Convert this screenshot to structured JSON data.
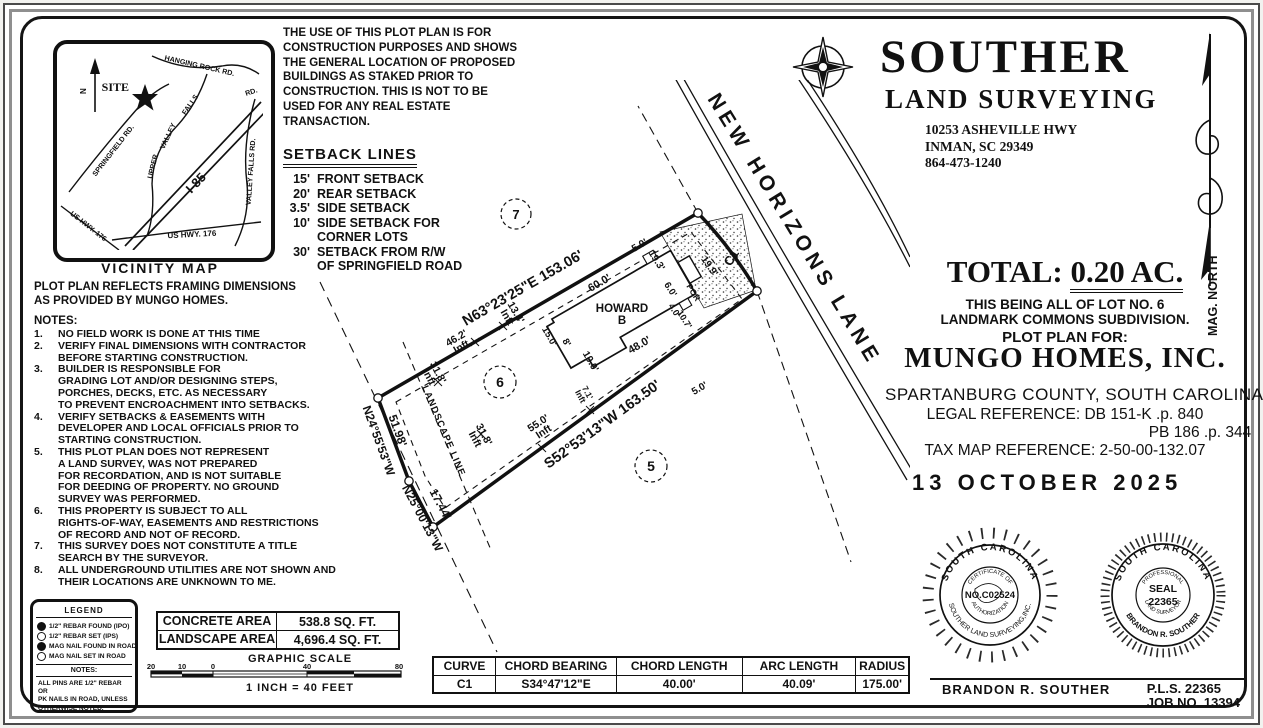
{
  "vicinity": {
    "title": "VICINITY MAP",
    "site_label": "SITE",
    "north_label": "N",
    "roads": {
      "hanging_rock": "HANGING ROCK RD.",
      "rd2": "RD.",
      "falls": "FALLS",
      "valley": "VALLEY",
      "upper": "UPPER",
      "springfield": "SPRINGFIELD RD.",
      "i85": "I-85",
      "valley_falls": "VALLEY FALLS RD.",
      "us176_a": "US HWY. 176",
      "us176_b": "US  HWY.  176"
    }
  },
  "disclaimer": {
    "lines": [
      "THE USE OF THIS PLOT PLAN IS FOR",
      "CONSTRUCTION PURPOSES AND SHOWS",
      "THE GENERAL LOCATION OF PROPOSED",
      "BUILDINGS AS STAKED PRIOR TO",
      "CONSTRUCTION. THIS IS NOT TO BE",
      "USED FOR ANY REAL ESTATE",
      "TRANSACTION."
    ]
  },
  "setbacks": {
    "title": "SETBACK LINES",
    "items": [
      {
        "num": "15'",
        "line1": "FRONT SETBACK",
        "line2": ""
      },
      {
        "num": "20'",
        "line1": "REAR SETBACK",
        "line2": ""
      },
      {
        "num": "3.5'",
        "line1": "SIDE SETBACK",
        "line2": ""
      },
      {
        "num": "10'",
        "line1": "SIDE SETBACK FOR",
        "line2": "CORNER LOTS"
      },
      {
        "num": "30'",
        "line1": "SETBACK FROM R/W",
        "line2": "OF SPRINGFIELD ROAD"
      }
    ]
  },
  "brand": {
    "name": "SOUTHER",
    "tagline": "LAND SURVEYING",
    "address1": "10253 ASHEVILLE HWY",
    "address2": "INMAN, SC 29349",
    "phone": "864-473-1240"
  },
  "mag_north": "MAG. NORTH",
  "title_block": {
    "total_prefix": "TOTAL: ",
    "total_value": "0.20 AC.",
    "being1": "THIS BEING ALL OF LOT NO. 6",
    "being2": "LANDMARK COMMONS SUBDIVISION.",
    "plot_plan_for": "PLOT PLAN FOR:",
    "client": "MUNGO HOMES, INC.",
    "county": "SPARTANBURG COUNTY, SOUTH CAROLINA",
    "legal_ref": "LEGAL REFERENCE: DB 151-K .p. 840",
    "legal_ref2": "PB 186 .p. 344",
    "tax_ref": "TAX MAP REFERENCE: 2-50-00-132.07",
    "date": "13 OCTOBER 2025"
  },
  "framing_note": {
    "line1": "PLOT PLAN REFLECTS FRAMING DIMENSIONS",
    "line2": "AS PROVIDED BY MUNGO HOMES."
  },
  "notes": {
    "title": "NOTES:",
    "items": [
      {
        "num": "1.",
        "lines": [
          "NO FIELD WORK IS DONE AT THIS TIME"
        ]
      },
      {
        "num": "2.",
        "lines": [
          "VERIFY FINAL DIMENSIONS WITH CONTRACTOR",
          "BEFORE STARTING CONSTRUCTION."
        ]
      },
      {
        "num": "3.",
        "lines": [
          "BUILDER IS RESPONSIBLE FOR",
          "GRADING LOT AND/OR DESIGNING STEPS,",
          "PORCHES, DECKS, ETC. AS NECESSARY",
          "TO PREVENT ENCROACHMENT INTO SETBACKS."
        ]
      },
      {
        "num": "4.",
        "lines": [
          "VERIFY SETBACKS & EASEMENTS WITH",
          "DEVELOPER AND LOCAL OFFICIALS PRIOR TO",
          "STARTING CONSTRUCTION."
        ]
      },
      {
        "num": "5.",
        "lines": [
          "THIS PLOT PLAN DOES NOT REPRESENT",
          "A LAND SURVEY, WAS NOT PREPARED",
          "FOR RECORDATION, AND IS NOT SUITABLE",
          "FOR DEEDING OF PROPERTY.  NO GROUND",
          "SURVEY WAS PERFORMED."
        ]
      },
      {
        "num": "6.",
        "lines": [
          "THIS PROPERTY IS SUBJECT TO ALL",
          "RIGHTS-OF-WAY, EASEMENTS AND RESTRICTIONS",
          "OF RECORD AND NOT OF RECORD."
        ]
      },
      {
        "num": "7.",
        "lines": [
          "THIS SURVEY DOES NOT CONSTITUTE A TITLE",
          "SEARCH BY THE SURVEYOR."
        ]
      },
      {
        "num": "8.",
        "lines": [
          "ALL UNDERGROUND UTILITIES ARE NOT SHOWN AND",
          "THEIR LOCATIONS ARE UNKNOWN TO ME."
        ]
      }
    ]
  },
  "legend": {
    "title": "LEGEND",
    "items": [
      {
        "symbol": "filled-circle",
        "label": "1/2\" REBAR FOUND (IPO)"
      },
      {
        "symbol": "open-circle",
        "label": "1/2\" REBAR SET (IPS)"
      },
      {
        "symbol": "filled-circle",
        "label": "MAG NAIL FOUND IN ROAD"
      },
      {
        "symbol": "open-circle",
        "label": "MAG NAIL SET IN ROAD"
      }
    ],
    "notes_title": "NOTES:",
    "note_lines": [
      "ALL PINS ARE 1/2\" REBAR OR",
      "PK NAILS IN ROAD, UNLESS",
      "OTHERWISE NOTED."
    ]
  },
  "areas": {
    "rows": [
      {
        "label": "CONCRETE AREA",
        "value": "538.8 SQ. FT."
      },
      {
        "label": "LANDSCAPE AREA",
        "value": "4,696.4 SQ. FT."
      }
    ]
  },
  "scale": {
    "title": "GRAPHIC SCALE",
    "ticks": [
      "20",
      "10",
      "0",
      "40",
      "80"
    ],
    "caption": "1 INCH = 40 FEET"
  },
  "curve_table": {
    "headers": [
      "CURVE",
      "CHORD BEARING",
      "CHORD LENGTH",
      "ARC LENGTH",
      "RADIUS"
    ],
    "row": [
      "C1",
      "S34°47'12\"E",
      "40.00'",
      "40.09'",
      "175.00'"
    ]
  },
  "seals": {
    "seal1": {
      "top": "SOUTH CAROLINA",
      "bottom": "SOUTHER LAND SURVEYING,INC.",
      "inner_top": "CERTIFICATE OF",
      "center": "NO.C02524",
      "inner_bottom": "AUTHORIZATION"
    },
    "seal2": {
      "top": "SOUTH CAROLINA",
      "bottom": "BRANDON R. SOUTHER",
      "inner_top": "PROFESSIONAL",
      "center1": "SEAL",
      "center2": "22365",
      "inner_bottom": "LAND SURVEYOR"
    }
  },
  "signature": {
    "name": "BRANDON R. SOUTHER",
    "pls": "P.L.S.  22365",
    "job": "JOB NO. 13394"
  },
  "plot": {
    "street": "NEW HORIZONS LANE",
    "curve_label": "C1",
    "bearing_front": "N63°23'25\"E   153.06'",
    "bearing_rear": "S52°53'13\"W   163.50'",
    "left1_dist": "51.98'",
    "left1_bearing": "N24°55'53\"W",
    "left2_dist": "17.44'",
    "left2_bearing": "N25°00'13\"W",
    "lot_this": "6",
    "lot_adj_upper": "7",
    "lot_adj_lower": "5",
    "house_name1": "HOWARD",
    "house_name2": "B",
    "porch": "POR",
    "landscape_line": "LANDSCAPE LINE",
    "dims": {
      "front": "60.0'",
      "rear": "48.0'",
      "gap_top": "5.0'",
      "gap_side": "5.0'",
      "d193": "19.3'",
      "d60": "6.0'",
      "d40": "4.0'",
      "d107": "10.7'",
      "d199": "19.9'",
      "d190": "19.0'",
      "d8": "8'",
      "d150": "15.0'"
    },
    "inft": {
      "unit": "Inft",
      "a": "46.2'",
      "b": "13.4'",
      "c": "31.8'",
      "d": "31.8'",
      "e": "55.0'",
      "f": "7.1'"
    }
  }
}
